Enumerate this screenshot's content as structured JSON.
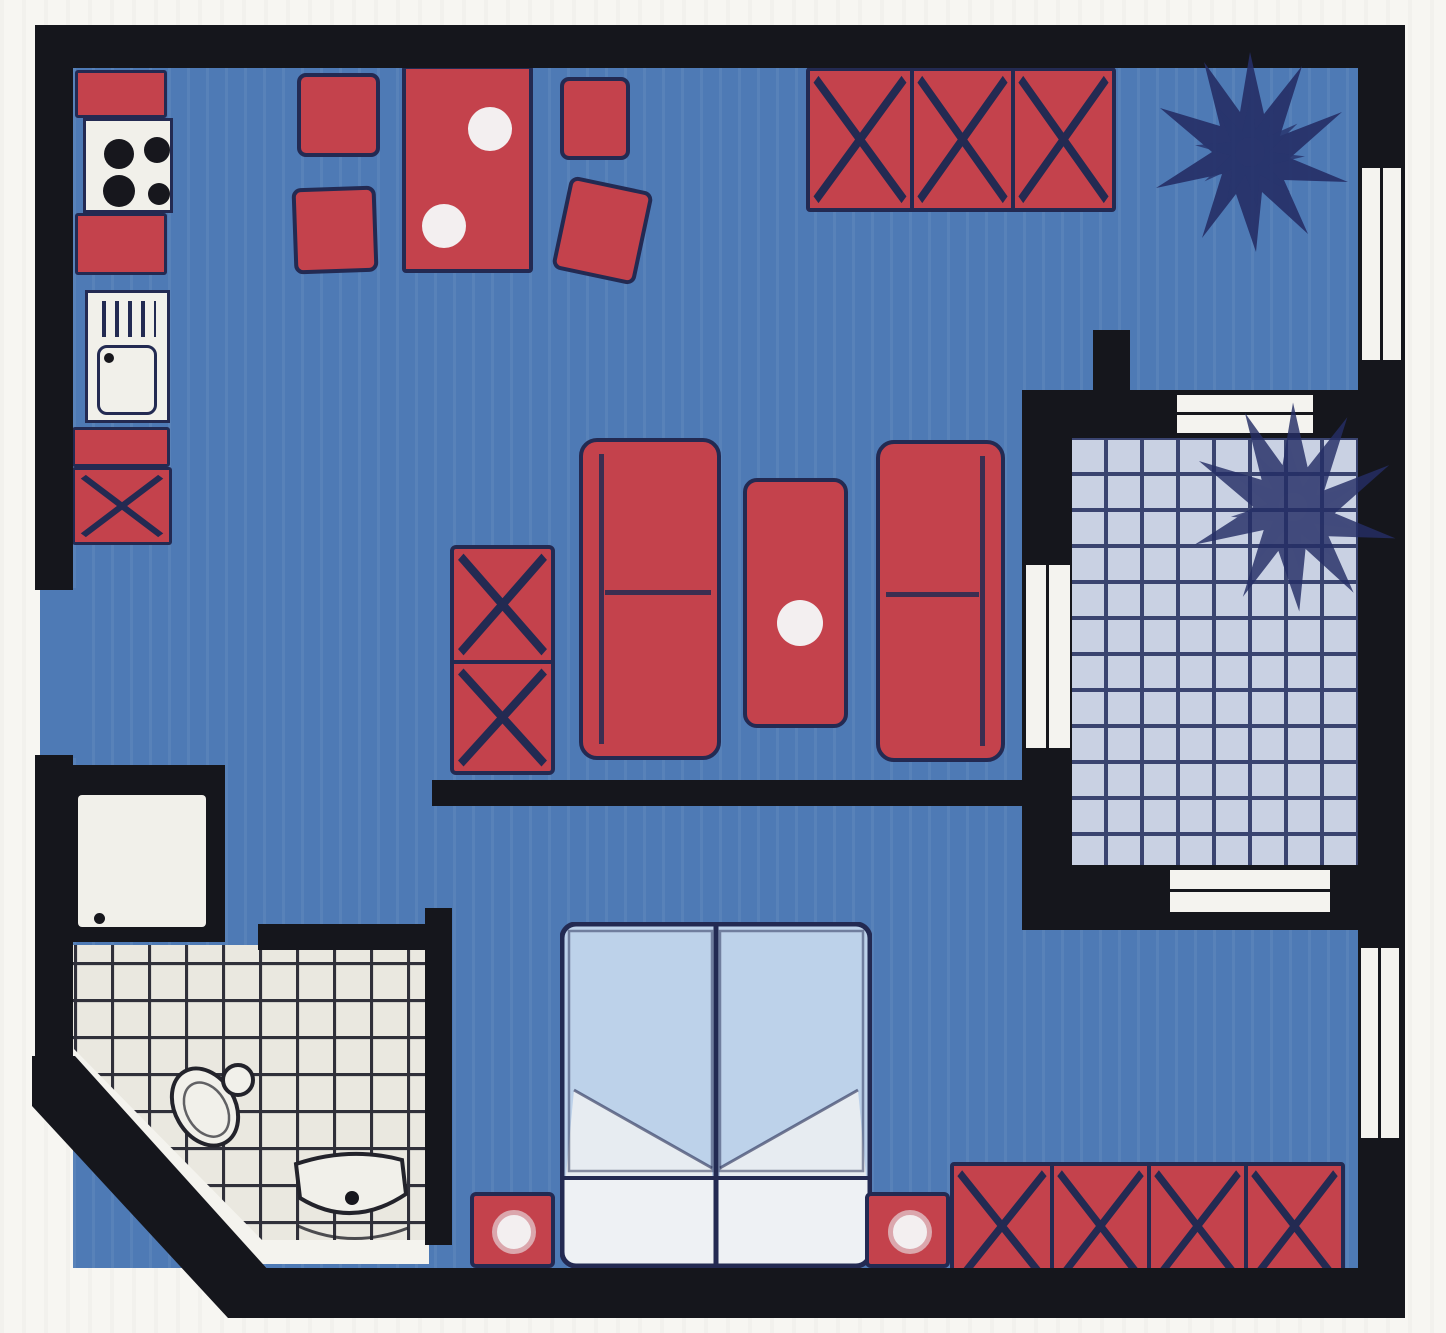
{
  "meta": {
    "kind": "scanned-apartment-floor-plan",
    "description": "Hand-colored top-down floor plan of a one-bedroom apartment with balcony; blue floors, red furniture, tiled bathroom and balcony, no text labels"
  },
  "colors": {
    "bg": "#f7f6f2",
    "wall": "#15161c",
    "ink": "#232a52",
    "floor": "#4e7ab5",
    "furn": "#c4424c",
    "plate": "#f3eff0",
    "bath-tile": "#eae8e0",
    "bath-line": "#30303a",
    "bath-base": "#f4f3ee",
    "balc-tile": "#c9d1e3",
    "balc-line": "#3a4470",
    "bed-blue": "#bdd2ea",
    "bed-fold": "#e7ecf1",
    "bed-white": "#eef1f4",
    "fixture": "#f1f0ea",
    "window": "#f4f3ef",
    "plant": "#252e66"
  },
  "rooms": {
    "kitchen": {
      "items": [
        "counter",
        "stove-four-burners",
        "counter",
        "sink-unit",
        "counter",
        "base-cabinet-x"
      ]
    },
    "dining": {
      "items": [
        "dining-table",
        "plate",
        "plate",
        "chair",
        "chair",
        "chair",
        "chair-tilted"
      ]
    },
    "living": {
      "items": [
        "sideboard-three-x-panels",
        "potted-plant",
        "tall-cabinet-two-x-panels",
        "sofa",
        "coffee-table-with-plate",
        "sofa"
      ]
    },
    "bedroom": {
      "items": [
        "double-bed-two-mattresses",
        "nightstand-with-lamp",
        "nightstand-with-lamp",
        "wardrobe-four-x-panels"
      ]
    },
    "bathroom": {
      "items": [
        "washing-machine",
        "toilet",
        "wash-basin",
        "tiled-floor",
        "chamfered-corner-wall"
      ]
    },
    "balcony": {
      "items": [
        "tiled-floor",
        "potted-plant",
        "balcony-door",
        "balcony-windows"
      ]
    },
    "openings": {
      "items": [
        "entrance-gap-left-wall",
        "window-right-top",
        "window-right-bottom",
        "balcony-window-top",
        "balcony-window-bottom",
        "balcony-door"
      ]
    }
  }
}
